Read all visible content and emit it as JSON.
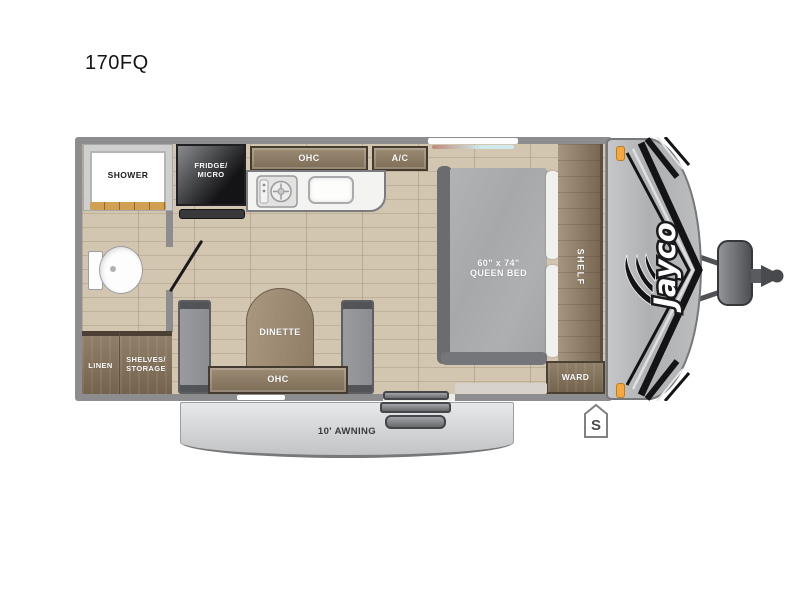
{
  "title": "170FQ",
  "brand": {
    "logo_text": "Jayco"
  },
  "rooms": {
    "shower": {
      "label": "SHOWER"
    },
    "fridge": {
      "line1": "FRIDGE/",
      "line2": "MICRO"
    },
    "kitchen_ohc": {
      "label": "OHC"
    },
    "ac": {
      "label": "A/C"
    },
    "bed": {
      "size_line": "60\" x 74\"",
      "name_line": "QUEEN BED"
    },
    "shelf": {
      "label": "SHELF"
    },
    "ward": {
      "label": "WARD"
    },
    "dinette": {
      "label": "DINETTE"
    },
    "dinette_ohc": {
      "label": "OHC"
    },
    "linen": {
      "label": "LINEN"
    },
    "shelves_storage": {
      "line1": "SHELVES/",
      "line2": "STORAGE"
    }
  },
  "exterior": {
    "awning": {
      "label": "10' AWNING"
    },
    "stabilizer_marker": {
      "label": "S"
    }
  },
  "colors": {
    "wall": "#8d8d90",
    "floor_wood": "#cdc1ab",
    "cabinet_wood": "#8d7c66",
    "cabinet_trim": "#443a2e",
    "fridge_dark": "#1d1d1f",
    "bed_mattress": "#abacae",
    "pillow_white": "#f0f0ee",
    "bench_gray": "#94959a",
    "dinette_table_wood": "#a08d74",
    "front_cap_gray": "#b9babc",
    "graphics_black": "#141416",
    "marker_light_orange": "#f5a83d",
    "awning_gray": "#d3d4d6",
    "counter_white": "#f3f3f1",
    "shower_ledge_tan": "#d1a050"
  }
}
